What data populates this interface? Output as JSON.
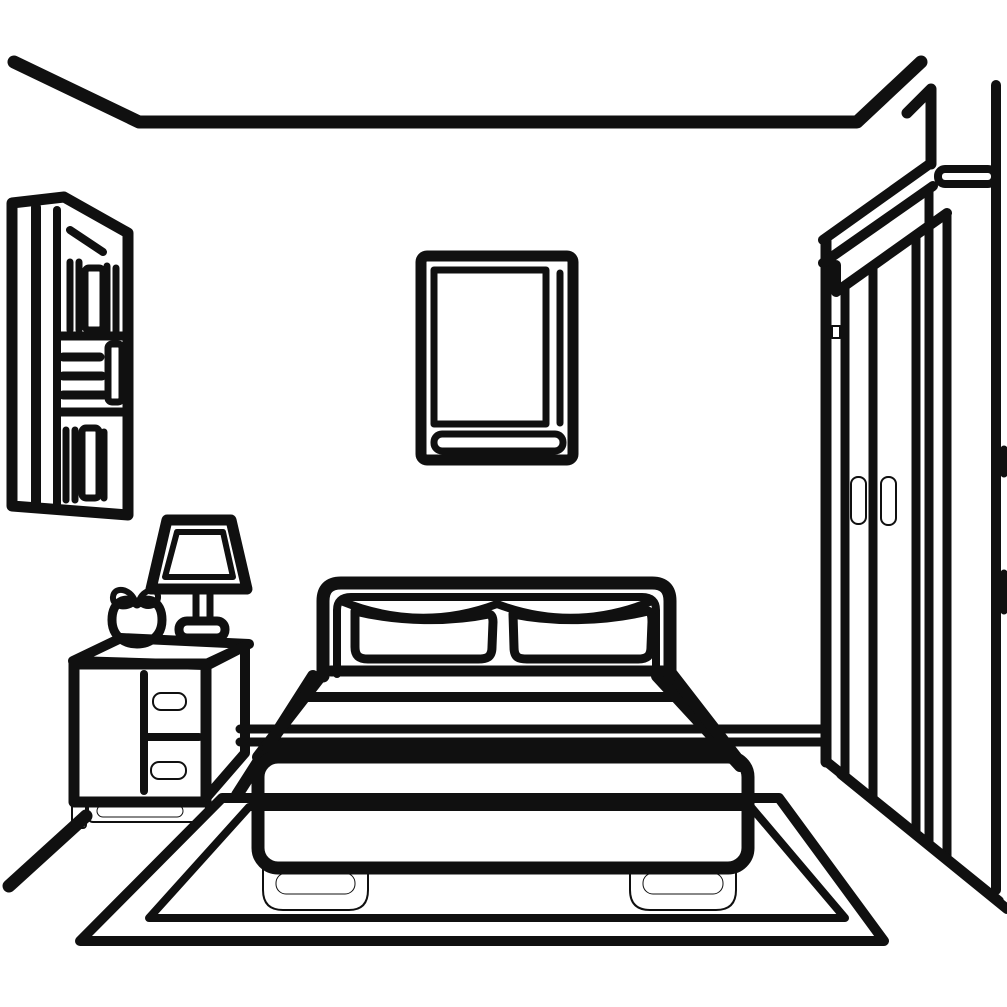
{
  "scene": {
    "title": "Black and white line drawing of a bedroom",
    "style": "single-line clip-art illustration",
    "background_color": "#ffffff",
    "line_color": "#101010",
    "leaf_accent_color": "#4e721d",
    "objects": [
      {
        "id": "ceiling",
        "description": "ceiling edge lines with left and right corner diagonals"
      },
      {
        "id": "bookshelf",
        "description": "wall bookshelf on left wall with vertical and stacked horizontal books"
      },
      {
        "id": "picture-frame",
        "description": "framed picture on back wall with inner mat and bottom strip"
      },
      {
        "id": "bed",
        "description": "double bed with headboard, two pillows, blanket, base and two feet"
      },
      {
        "id": "nightstand",
        "description": "bedside table with two drawers, pill handles, plinth and leg"
      },
      {
        "id": "lamp",
        "description": "bedside lamp with trapezoid shade, double stem and base"
      },
      {
        "id": "apple",
        "description": "apple with two leaves on the nightstand, left leaf green"
      },
      {
        "id": "wardrobe",
        "description": "tall wardrobe in right corner with slanted cornice, two door handles and hinge"
      },
      {
        "id": "rug",
        "description": "double-bordered rug under the bed"
      },
      {
        "id": "floor",
        "description": "wall-floor boundary lines and left baseboard diagonal"
      }
    ]
  },
  "svg": {
    "view_box": "0 0 1007 1007",
    "shapes": [
      {
        "name": "ceiling-line",
        "tag": "path",
        "attrs": {
          "d": "M 14,62 L 139,122 H 857 L 921,62",
          "stroke-width": 13
        }
      },
      {
        "name": "wall-corner-right",
        "tag": "path",
        "attrs": {
          "d": "M 907,113 L 931,89 V 164",
          "stroke-width": 11
        }
      },
      {
        "name": "wall-corner-right-edge",
        "tag": "path",
        "attrs": {
          "d": "M 996,85 V 890",
          "stroke-width": 10
        }
      },
      {
        "name": "bookshelf-frame",
        "tag": "path",
        "attrs": {
          "d": "M 12,203 L 64,197 L 128,233 V 515 L 12,506 Z",
          "stroke-width": 11
        }
      },
      {
        "name": "bookshelf-side-line-1",
        "tag": "path",
        "attrs": {
          "d": "M 36,207 V 503",
          "stroke-width": 10
        }
      },
      {
        "name": "bookshelf-side-line-2",
        "tag": "path",
        "attrs": {
          "d": "M 57,210 V 505",
          "stroke-width": 8
        }
      },
      {
        "name": "bookshelf-slanted-book",
        "tag": "path",
        "attrs": {
          "d": "M 70,230 L 103,252",
          "stroke-width": 8
        }
      },
      {
        "name": "books-top-shelf",
        "tag": "path",
        "attrs": {
          "d": "M 70,262 V 330 M 79,262 V 330 M 107,266 V 332 M 116,268 V 332",
          "stroke-width": 7
        }
      },
      {
        "name": "books-top-wide-book",
        "tag": "rect",
        "attrs": {
          "x": 85,
          "y": 268,
          "width": 18,
          "height": 62,
          "rx": 4,
          "stroke-width": 7
        }
      },
      {
        "name": "shelf-divider-1",
        "tag": "path",
        "attrs": {
          "d": "M 60,336 H 126",
          "stroke-width": 9
        }
      },
      {
        "name": "books-mid-stack",
        "tag": "path",
        "attrs": {
          "d": "M 63,357 H 100 M 63,376 H 102 M 63,395 H 104",
          "stroke-width": 9
        }
      },
      {
        "name": "books-mid-vertical-book",
        "tag": "rect",
        "attrs": {
          "x": 108,
          "y": 344,
          "width": 14,
          "height": 58,
          "rx": 4,
          "stroke-width": 7
        }
      },
      {
        "name": "shelf-divider-2",
        "tag": "path",
        "attrs": {
          "d": "M 60,412 H 128",
          "stroke-width": 9
        }
      },
      {
        "name": "books-bottom-shelf",
        "tag": "path",
        "attrs": {
          "d": "M 66,430 V 500 M 75,430 V 500 M 104,432 V 498",
          "stroke-width": 7
        }
      },
      {
        "name": "books-bottom-wide-book",
        "tag": "rect",
        "attrs": {
          "x": 82,
          "y": 428,
          "width": 17,
          "height": 70,
          "rx": 4,
          "stroke-width": 7
        }
      },
      {
        "name": "picture-frame-outer",
        "tag": "rect",
        "attrs": {
          "x": 421,
          "y": 256,
          "width": 152,
          "height": 204,
          "rx": 6,
          "stroke-width": 11
        }
      },
      {
        "name": "picture-frame-inner",
        "tag": "rect",
        "attrs": {
          "x": 434,
          "y": 270,
          "width": 112,
          "height": 154,
          "stroke-width": 7
        }
      },
      {
        "name": "picture-frame-right-line",
        "tag": "path",
        "attrs": {
          "d": "M 560,273 V 423",
          "stroke-width": 7
        }
      },
      {
        "name": "picture-frame-bottom-strip",
        "tag": "rect",
        "attrs": {
          "x": 434,
          "y": 434,
          "width": 129,
          "height": 17,
          "rx": 8,
          "stroke-width": 7
        }
      },
      {
        "name": "wall-floor-line",
        "tag": "path",
        "attrs": {
          "d": "M 240,729 H 824 M 240,742 H 824",
          "stroke-width": 9
        }
      },
      {
        "name": "baseboard-left-diagonal",
        "tag": "path",
        "attrs": {
          "d": "M 86,816 L 9,886",
          "stroke-width": 13
        }
      },
      {
        "name": "rug-outer-border",
        "tag": "path",
        "attrs": {
          "d": "M 222,798 H 779 L 884,941 H 80 Z",
          "stroke-width": 10
        }
      },
      {
        "name": "rug-inner-border",
        "tag": "path",
        "attrs": {
          "d": "M 249,807 H 751 L 845,918 H 149 Z",
          "stroke-width": 8
        }
      },
      {
        "name": "wardrobe-left-edge",
        "tag": "path",
        "attrs": {
          "d": "M 826,241 V 762",
          "stroke-width": 11
        }
      },
      {
        "name": "wardrobe-cornice",
        "tag": "path",
        "attrs": {
          "d": "M 823,240 L 931,163 M 823,263 L 933,186 M 836,265 V 292 L 947,213",
          "stroke-width": 10
        }
      },
      {
        "name": "wardrobe-top-face-pill",
        "tag": "rect",
        "attrs": {
          "x": 938,
          "y": 169,
          "width": 57,
          "height": 15,
          "rx": 7,
          "stroke-width": 8
        }
      },
      {
        "name": "wardrobe-front-corner-lines",
        "tag": "path",
        "attrs": {
          "d": "M 929,190 V 845 M 947,213 V 858",
          "stroke-width": 9
        }
      },
      {
        "name": "wardrobe-door-lines",
        "tag": "path",
        "attrs": {
          "d": "M 845,286 V 777 M 873,266 V 799 M 916,235 V 834",
          "stroke-width": 9
        }
      },
      {
        "name": "wardrobe-hinge",
        "tag": "rect",
        "attrs": {
          "x": 832,
          "y": 326,
          "width": 8,
          "height": 12,
          "fill": "#101010",
          "stroke-width": 2
        }
      },
      {
        "name": "wardrobe-handle-left",
        "tag": "rect",
        "attrs": {
          "x": 851,
          "y": 477,
          "width": 15,
          "height": 47,
          "rx": 7,
          "fill": "#101010",
          "stroke-width": 2
        }
      },
      {
        "name": "wardrobe-handle-right",
        "tag": "rect",
        "attrs": {
          "x": 881,
          "y": 477,
          "width": 15,
          "height": 48,
          "rx": 7,
          "fill": "#101010",
          "stroke-width": 2
        }
      },
      {
        "name": "wardrobe-base-diagonals",
        "tag": "path",
        "attrs": {
          "d": "M 827,762 L 999,901 M 841,774 L 1007,909",
          "stroke-width": 10
        }
      },
      {
        "name": "edge-door-handle-dashes",
        "tag": "path",
        "attrs": {
          "d": "M 1004,449 V 474 M 1004,573 V 611",
          "stroke-width": 7
        }
      },
      {
        "name": "bed-rail-left",
        "tag": "path",
        "attrs": {
          "d": "M 313,676 L 237,795",
          "stroke-width": 12
        }
      },
      {
        "name": "bed-rail-right",
        "tag": "path",
        "attrs": {
          "d": "M 657,676 L 740,766",
          "stroke-width": 12
        }
      },
      {
        "name": "blanket-fill",
        "tag": "path",
        "attrs": {
          "d": "M 330,671 L 664,671 L 737,757 L 258,757 Z",
          "fill": "#ffffff",
          "stroke": "none"
        }
      },
      {
        "name": "mattress-top-line",
        "tag": "path",
        "attrs": {
          "d": "M 331,671 H 663",
          "stroke-width": 11
        }
      },
      {
        "name": "mattress-second-line",
        "tag": "path",
        "attrs": {
          "d": "M 308,697 H 687",
          "stroke-width": 10
        }
      },
      {
        "name": "blanket-side-flares",
        "tag": "path",
        "attrs": {
          "d": "M 323,673 L 258,757 M 671,673 L 736,757",
          "stroke-width": 12
        }
      },
      {
        "name": "blanket-fold-line",
        "tag": "path",
        "attrs": {
          "d": "M 267,748 H 728",
          "stroke-width": 10
        }
      },
      {
        "name": "headboard-outline",
        "tag": "path",
        "attrs": {
          "d": "M 323,676 V 601 Q 323,583 341,583 H 652 Q 670,583 670,601 V 676",
          "fill": "#ffffff",
          "stroke-width": 13
        }
      },
      {
        "name": "headboard-inner-line",
        "tag": "path",
        "attrs": {
          "d": "M 337,674 V 610 Q 337,597 351,597 H 642 Q 656,597 656,610 V 674",
          "stroke-width": 8
        }
      },
      {
        "name": "sheet-top-curve",
        "tag": "path",
        "attrs": {
          "d": "M 341,601 Q 420,633 497,604 Q 574,633 652,601",
          "stroke-width": 8
        }
      },
      {
        "name": "pillow-left",
        "tag": "path",
        "attrs": {
          "d": "M 355,611 C 400,622 450,622 489,614 C 492,615 493,618 493,622 L 492,647 C 492,658 486,659 478,659 L 368,659 C 358,659 355,655 355,647 Z",
          "fill": "#ffffff",
          "stroke-width": 9
        }
      },
      {
        "name": "pillow-right",
        "tag": "path",
        "attrs": {
          "d": "M 513,614 C 552,622 602,622 648,611 C 651,612 652,615 652,622 L 651,647 C 651,655 648,659 638,659 L 527,659 C 519,659 514,658 514,647 Z",
          "fill": "#ffffff",
          "stroke-width": 9
        }
      },
      {
        "name": "bed-base",
        "tag": "rect",
        "attrs": {
          "x": 258,
          "y": 757,
          "width": 490,
          "height": 111,
          "rx": 20,
          "fill": "#ffffff",
          "stroke-width": 13
        }
      },
      {
        "name": "bed-foot-left",
        "tag": "path",
        "attrs": {
          "d": "M 263,866 V 890 Q 263,910 283,910 L 349,910 Q 368,910 368,890 V 866 Z",
          "fill": "#101010",
          "stroke-width": 2
        }
      },
      {
        "name": "bed-foot-left-inner",
        "tag": "rect",
        "attrs": {
          "x": 276,
          "y": 873,
          "width": 79,
          "height": 21,
          "rx": 10,
          "fill": "#ffffff",
          "stroke": "none"
        }
      },
      {
        "name": "bed-foot-right",
        "tag": "path",
        "attrs": {
          "d": "M 630,866 V 890 Q 630,910 650,910 L 716,910 Q 736,910 736,890 V 866 Z",
          "fill": "#101010",
          "stroke-width": 2
        }
      },
      {
        "name": "bed-foot-right-inner",
        "tag": "rect",
        "attrs": {
          "x": 643,
          "y": 873,
          "width": 80,
          "height": 21,
          "rx": 10,
          "fill": "#ffffff",
          "stroke": "none"
        }
      },
      {
        "name": "nightstand-top-face",
        "tag": "path",
        "attrs": {
          "d": "M 73,661 L 121,638 L 249,644 L 204,665 Z",
          "fill": "#ffffff",
          "stroke-width": 10
        }
      },
      {
        "name": "nightstand-side-face",
        "tag": "path",
        "attrs": {
          "d": "M 206,666 L 245,646 V 753 L 206,798 Z",
          "fill": "#ffffff",
          "stroke-width": 10
        }
      },
      {
        "name": "nightstand-front-face",
        "tag": "rect",
        "attrs": {
          "x": 74,
          "y": 664,
          "width": 132,
          "height": 138,
          "fill": "#ffffff",
          "stroke-width": 11
        }
      },
      {
        "name": "drawer-divider-vertical",
        "tag": "path",
        "attrs": {
          "d": "M 144,674 V 791",
          "stroke-width": 8
        }
      },
      {
        "name": "drawer-divider-horizontal",
        "tag": "path",
        "attrs": {
          "d": "M 144,737 H 199",
          "stroke-width": 8
        }
      },
      {
        "name": "drawer-handle-top",
        "tag": "rect",
        "attrs": {
          "x": 153,
          "y": 693,
          "width": 33,
          "height": 17,
          "rx": 8,
          "fill": "#101010",
          "stroke-width": 2
        }
      },
      {
        "name": "drawer-handle-bottom",
        "tag": "rect",
        "attrs": {
          "x": 151,
          "y": 762,
          "width": 35,
          "height": 17,
          "rx": 8,
          "fill": "#101010",
          "stroke-width": 2
        }
      },
      {
        "name": "nightstand-leg",
        "tag": "rect",
        "attrs": {
          "x": 72,
          "y": 800,
          "width": 14,
          "height": 28,
          "rx": 3,
          "fill": "#101010",
          "stroke-width": 2
        }
      },
      {
        "name": "nightstand-plinth",
        "tag": "rect",
        "attrs": {
          "x": 88,
          "y": 799,
          "width": 118,
          "height": 23,
          "rx": 5,
          "fill": "#101010",
          "stroke-width": 2
        }
      },
      {
        "name": "nightstand-plinth-inner",
        "tag": "rect",
        "attrs": {
          "x": 97,
          "y": 805,
          "width": 86,
          "height": 12,
          "rx": 6,
          "fill": "#ffffff",
          "stroke": "none"
        }
      },
      {
        "name": "lamp-shade",
        "tag": "path",
        "attrs": {
          "d": "M 167,520 L 231,520 L 247,589 L 151,589 Z",
          "fill": "#ffffff",
          "stroke-width": 11
        }
      },
      {
        "name": "lamp-shade-inner-line",
        "tag": "path",
        "attrs": {
          "d": "M 177,532 L 223,532 L 233,577 L 165,577 Z",
          "stroke-width": 6
        }
      },
      {
        "name": "lamp-stem",
        "tag": "path",
        "attrs": {
          "d": "M 196,589 V 621 M 210,589 V 621",
          "stroke-width": 7
        }
      },
      {
        "name": "lamp-base",
        "tag": "rect",
        "attrs": {
          "x": 179,
          "y": 621,
          "width": 46,
          "height": 17,
          "rx": 8,
          "fill": "#ffffff",
          "stroke-width": 9
        }
      },
      {
        "name": "apple-body",
        "tag": "path",
        "attrs": {
          "d": "M 137,604 C 127,596 112,600 112,620 C 112,636 124,644 137,644 C 150,644 162,636 162,620 C 162,600 147,596 137,604 Z",
          "fill": "#ffffff",
          "stroke-width": 9
        }
      },
      {
        "name": "apple-leaf-green",
        "tag": "path",
        "attrs": {
          "d": "M 135,601 C 130,588 114,586 113,597 C 112,607 128,610 135,601 Z",
          "fill": "#4e721d",
          "stroke-width": 6
        }
      },
      {
        "name": "apple-leaf-black",
        "tag": "path",
        "attrs": {
          "d": "M 139,601 C 143,589 157,587 158,596 C 159,606 145,610 139,601 Z",
          "fill": "#101010",
          "stroke-width": 6
        }
      }
    ]
  }
}
